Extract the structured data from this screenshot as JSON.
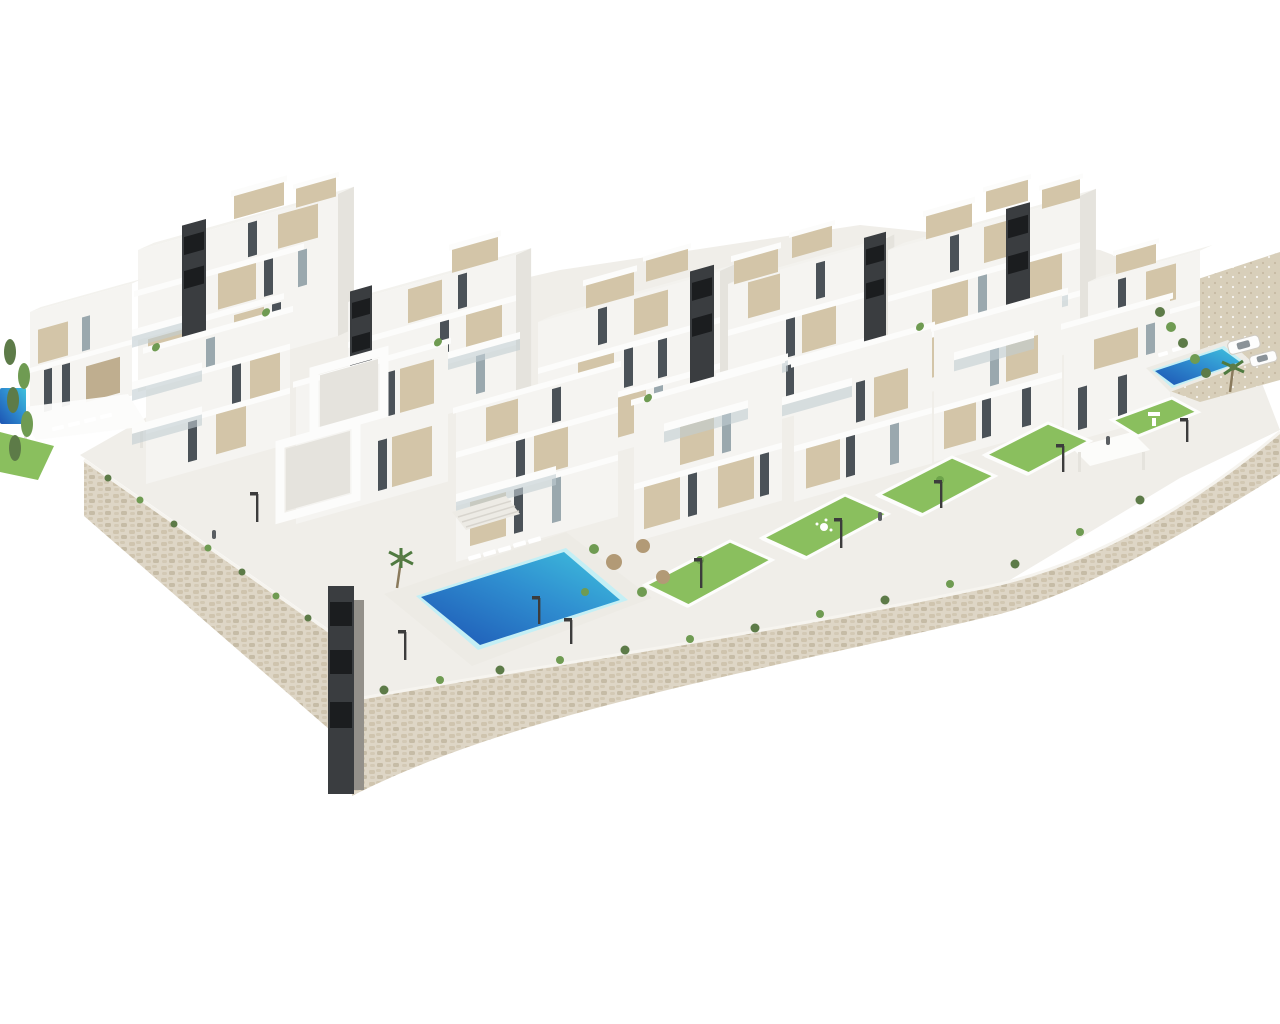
{
  "scene": {
    "description": "Aerial 3D architectural rendering of a modern white residential complex with terraced apartment blocks, beige facade panels, dark stair shafts, private gardens with lawns, a large communal swimming pool, a smaller villa pool, palm trees and beige stone retaining walls, on a plain white background."
  },
  "colors": {
    "background": "#ffffff",
    "ground_light": "#f0eee9",
    "path_light": "#edebe5",
    "facade_white": "#f5f4f1",
    "facade_bright": "#fcfcfb",
    "facade_shade": "#e5e3dd",
    "roof_light": "#f3f2ee",
    "panel_beige": "#d3c5a8",
    "panel_beige_dark": "#bfae8f",
    "window_dark": "#4b5258",
    "window_glass": "#9aa8ae",
    "balcony_glass": "#c2cdd2",
    "anthracite": "#3a3d40",
    "shaft_black": "#1b1d1f",
    "concrete_gray": "#93908a",
    "pool_deep": "#1d55b4",
    "pool_mid": "#2f8ed0",
    "pool_turquoise": "#3fc1dd",
    "pool_rim": "#c4eff5",
    "lawn_green": "#8abf5e",
    "lawn_dark": "#6da34a",
    "hedge_green": "#5d7b48",
    "tree_green": "#6f9b52",
    "stone_light": "#ded6c6",
    "stone_mid": "#cfc4ae",
    "stone_dark": "#b3a68c",
    "gravel_beige": "#d8cfba",
    "umbrella_tan": "#b29a76",
    "lamp_dark": "#3c3c3c",
    "car_white": "#fdfdfd",
    "car_glass": "#8a9298",
    "shadow_soft": "#d9d6cf",
    "people_gray": "#5a5e62"
  }
}
